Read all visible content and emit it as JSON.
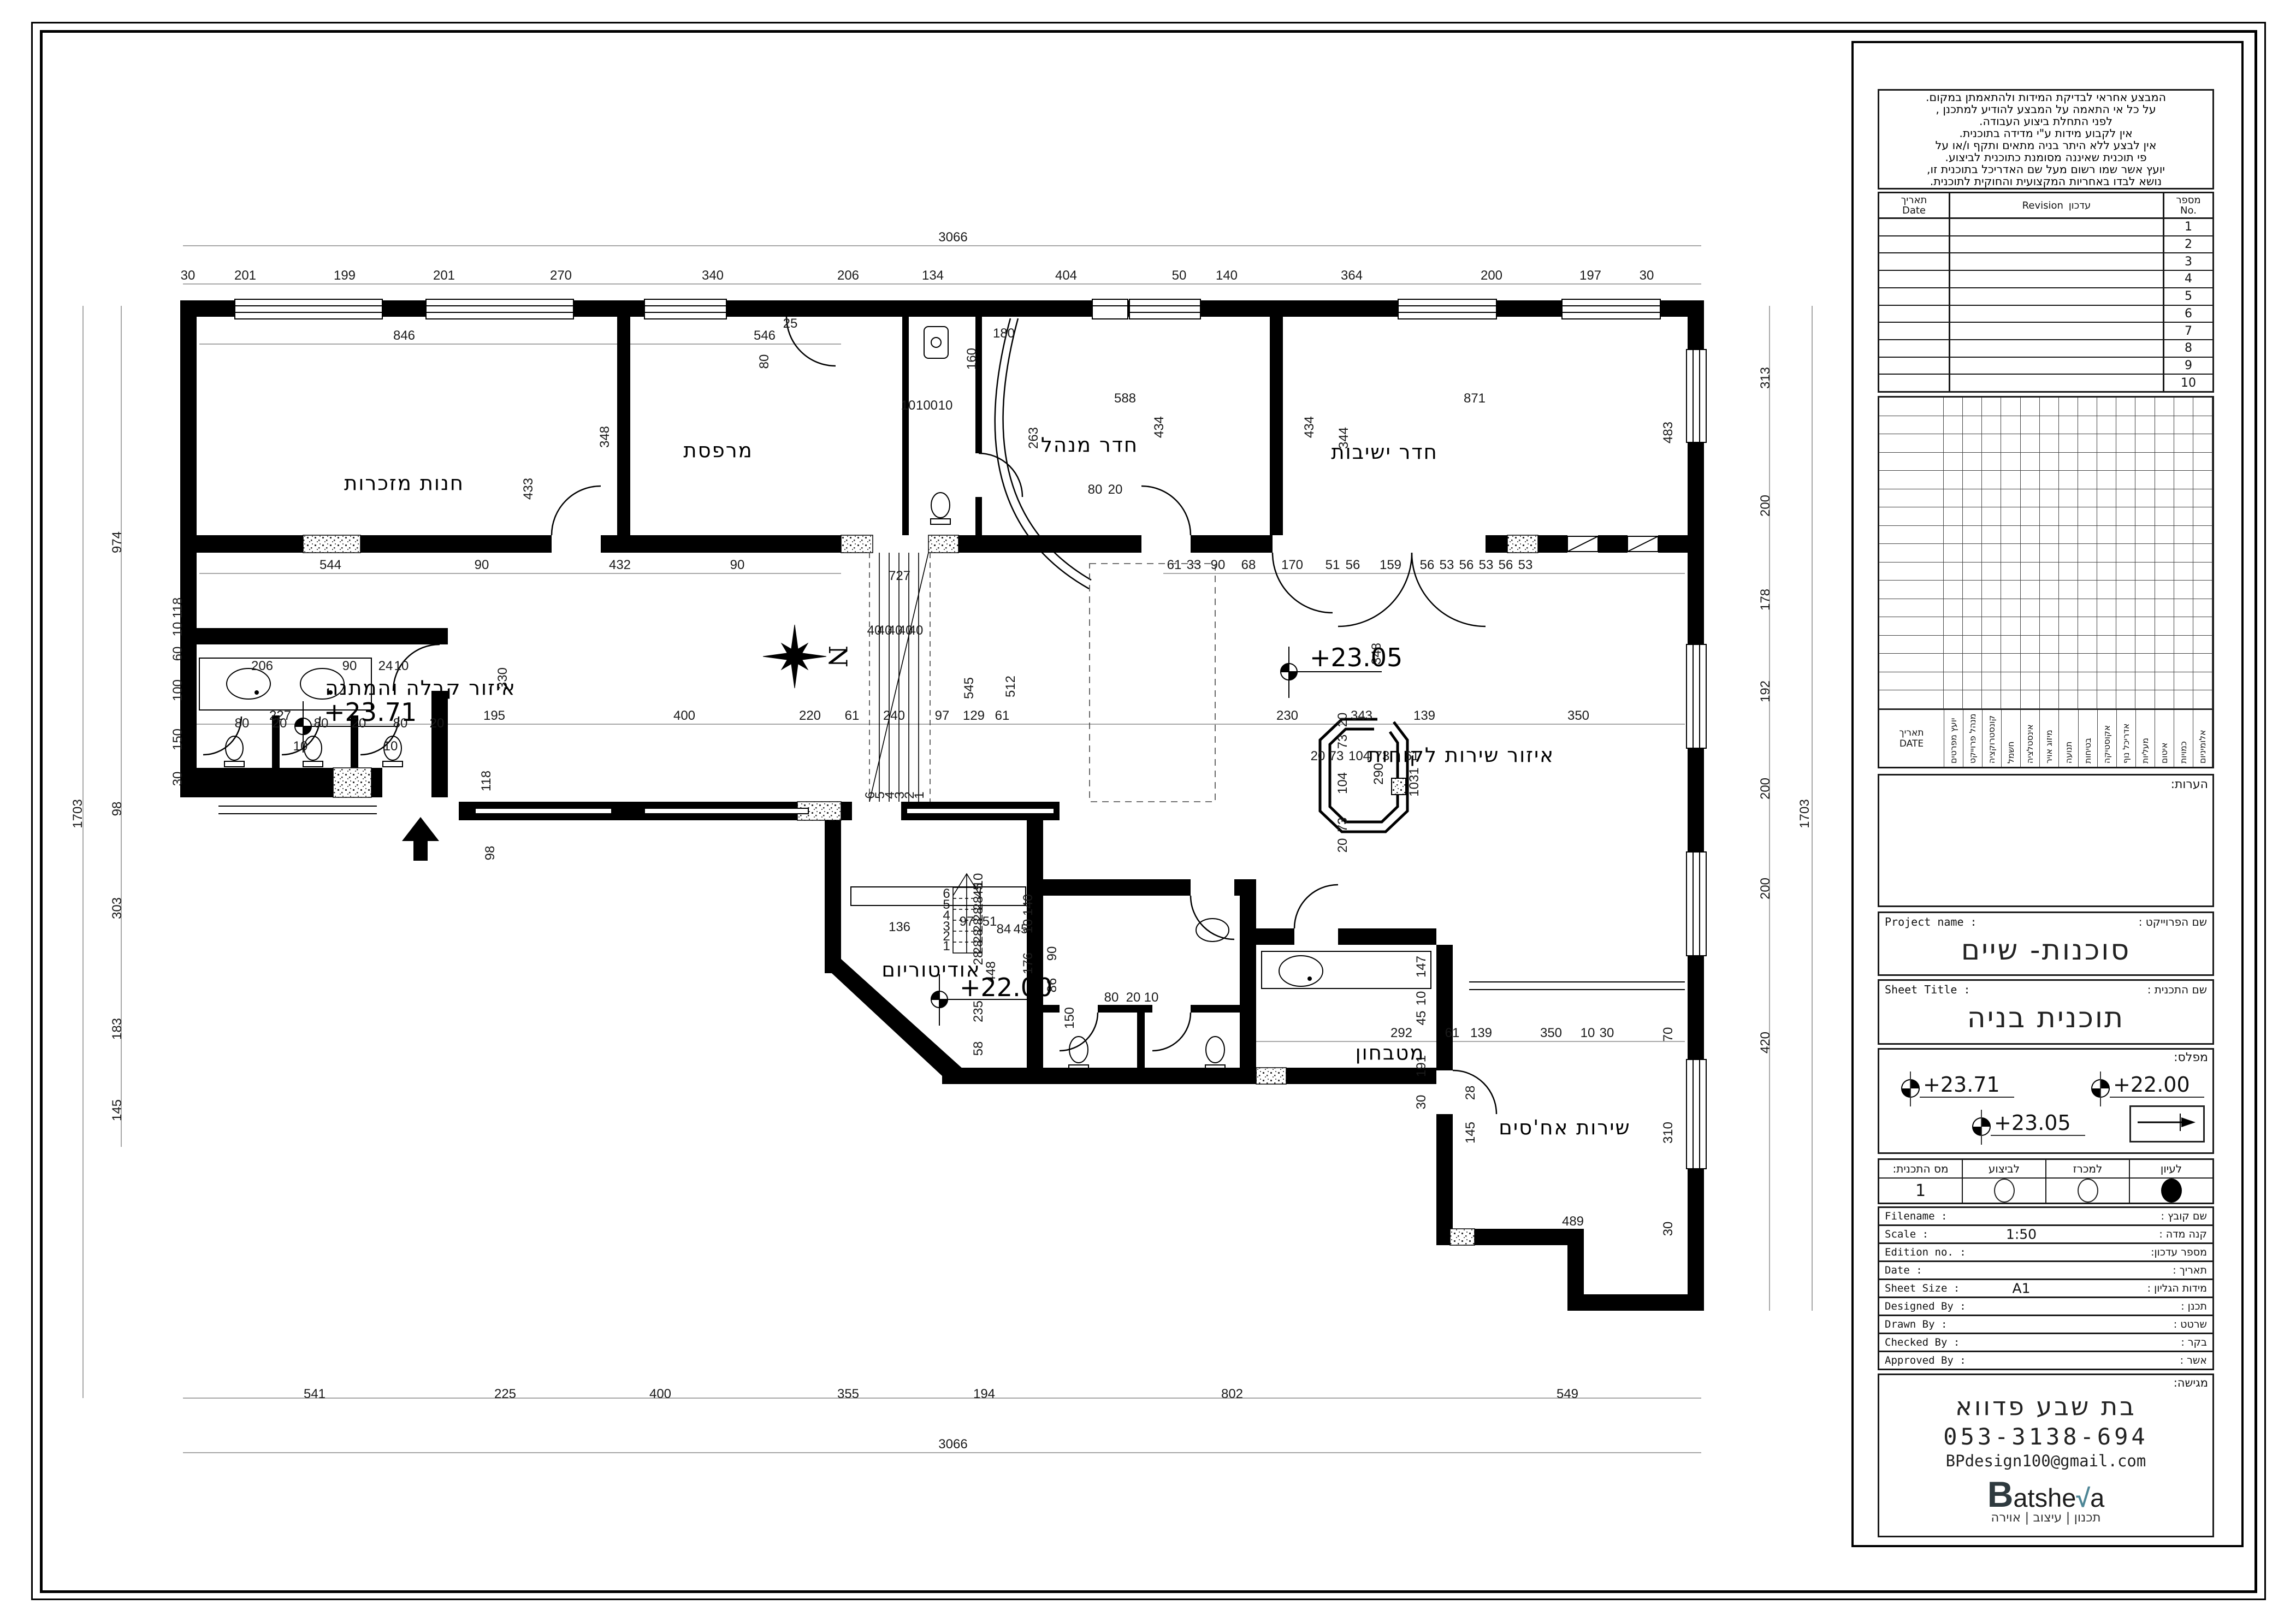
{
  "title_block": {
    "notes_lines": [
      "המבצע אחראי לבדיקת המידות ולהתאמתן במקום.",
      "על כל אי התאמה על המבצע להודיע למתכנן ,",
      "לפני התחלת ביצוע העבודה.",
      "אין לקבוע מידות ע\"י מדידה בתוכנית.",
      "אין לבצע ללא היתר בניה מתאים ותקף ו/או על",
      "פי תוכנית שאיננה מסומנת כתוכנית לביצוע.",
      "יועץ אשר שמו רשום מעל שם האדריכל בתוכנית זו,",
      "נושא לבדו באחריות המקצועית והחוקית לתוכנית."
    ],
    "revision": {
      "col_date_he": "תאריך",
      "col_date_en": "Date",
      "col_rev_he": "עדכון",
      "col_rev_en": "Revision",
      "col_no_he": "מספר",
      "col_no_en": "No.",
      "rows": [
        "1",
        "2",
        "3",
        "4",
        "5",
        "6",
        "7",
        "8",
        "9",
        "10"
      ]
    },
    "consultants": {
      "date_label_he": "תאריך",
      "date_label_en": "DATE",
      "columns": [
        "יועץ מפרטים",
        "מנהל פרוייקט",
        "קונסטרוקציה",
        "חשמל",
        "אינסטלציה",
        "מיזוג אויר",
        "תנועה",
        "בטיחות",
        "אקוסטיקה",
        "אדריכל נוף",
        "מעליות",
        "איטום",
        "כמויות",
        "אלומיניום"
      ]
    },
    "remarks_label": "הערות:",
    "project": {
      "label_en": "Project name :",
      "label_he": "שם הפרוייקט :",
      "value": "סוכנות- שיים"
    },
    "sheet": {
      "label_en": "Sheet Title :",
      "label_he": "שם התכנית :",
      "value": "תוכנית בניה"
    },
    "levels": {
      "label": "מפלס:",
      "items": [
        "+23.71",
        "+22.00",
        "+23.05"
      ]
    },
    "status": {
      "headers": [
        "מס התכנית:",
        "לביצוע",
        "למכרז",
        "לעיון"
      ],
      "plan_no": "1"
    },
    "info_rows": [
      {
        "en": "Filename :",
        "he": "שם קובץ :",
        "value": ""
      },
      {
        "en": "Scale :",
        "he": "קנה מדה :",
        "value": "1:50"
      },
      {
        "en": "Edition no. :",
        "he": "מספר עדכון:",
        "value": ""
      },
      {
        "en": "Date :",
        "he": "תאריך :",
        "value": ""
      },
      {
        "en": "Sheet Size :",
        "he": "מידות הגליון :",
        "value": "A1"
      },
      {
        "en": "Designed By :",
        "he": "תכנן :",
        "value": ""
      },
      {
        "en": "Drawn By :",
        "he": "שרטט :",
        "value": ""
      },
      {
        "en": "Checked By :",
        "he": "בקר :",
        "value": ""
      },
      {
        "en": "Approved By :",
        "he": "אשר :",
        "value": ""
      }
    ],
    "submitter": {
      "label": "מגישה:",
      "name": "בת שבע פדווא",
      "phone": "053-3138-694",
      "email": "BPdesign100@gmail.com",
      "logo": {
        "text": "Batsheva",
        "accent_color": "#4e8696"
      },
      "tagline": "תכנון | עיצוב | אוירה"
    }
  },
  "plan": {
    "north_label": "N",
    "rooms": [
      [
        740,
        897,
        "חנות מזכרות"
      ],
      [
        1315,
        837,
        "מרפסת"
      ],
      [
        1995,
        827,
        "חדר מנהל"
      ],
      [
        2535,
        840,
        "חדר ישיבות"
      ],
      [
        770,
        1272,
        "איזור קבלה והמתנה"
      ],
      [
        2675,
        1395,
        "איזור שירות לקוחות"
      ],
      [
        1705,
        1788,
        "אודיטוריום"
      ],
      [
        2545,
        1940,
        "מטבחון"
      ],
      [
        2865,
        2077,
        "שירות אח'סים"
      ]
    ],
    "levels": [
      [
        593,
        1320,
        "+23.71"
      ],
      [
        2398,
        1220,
        "+23.05"
      ],
      [
        1757,
        1824,
        "+22.00"
      ]
    ],
    "dims": [
      [
        344,
        512,
        "30"
      ],
      [
        449,
        512,
        "201"
      ],
      [
        631,
        512,
        "199"
      ],
      [
        813,
        512,
        "201"
      ],
      [
        1027,
        512,
        "270"
      ],
      [
        1305,
        512,
        "340"
      ],
      [
        1553,
        512,
        "206"
      ],
      [
        1708,
        512,
        "134"
      ],
      [
        1952,
        512,
        "404"
      ],
      [
        2159,
        512,
        "50"
      ],
      [
        2246,
        512,
        "140"
      ],
      [
        2475,
        512,
        "364"
      ],
      [
        2731,
        512,
        "200"
      ],
      [
        2912,
        512,
        "197"
      ],
      [
        3015,
        512,
        "30"
      ],
      [
        1745,
        442,
        "3066"
      ],
      [
        740,
        622,
        "846"
      ],
      [
        1400,
        622,
        "546"
      ],
      [
        1838,
        618,
        "180"
      ],
      [
        1447,
        600,
        "25"
      ],
      [
        2060,
        737,
        "588"
      ],
      [
        2700,
        737,
        "871"
      ],
      [
        1407,
        662,
        "80",
        1
      ],
      [
        975,
        895,
        "433",
        1
      ],
      [
        1115,
        800,
        "348",
        1
      ],
      [
        2130,
        782,
        "434",
        1
      ],
      [
        2405,
        782,
        "434",
        1
      ],
      [
        2468,
        802,
        "344",
        1
      ],
      [
        3062,
        792,
        "483",
        1
      ],
      [
        1787,
        657,
        "160",
        1
      ],
      [
        1900,
        802,
        "263",
        1
      ],
      [
        1663,
        750,
        "10"
      ],
      [
        1697,
        750,
        "100"
      ],
      [
        1731,
        750,
        "10"
      ],
      [
        2005,
        904,
        "80"
      ],
      [
        2042,
        904,
        "20"
      ],
      [
        605,
        1042,
        "544"
      ],
      [
        882,
        1042,
        "90"
      ],
      [
        1135,
        1042,
        "432"
      ],
      [
        1350,
        1042,
        "90"
      ],
      [
        2150,
        1042,
        "61"
      ],
      [
        2186,
        1042,
        "33"
      ],
      [
        2230,
        1042,
        "90"
      ],
      [
        2286,
        1042,
        "68"
      ],
      [
        2366,
        1042,
        "170"
      ],
      [
        2440,
        1042,
        "51"
      ],
      [
        2477,
        1042,
        "56"
      ],
      [
        2546,
        1042,
        "159"
      ],
      [
        2613,
        1042,
        "56"
      ],
      [
        2649,
        1042,
        "53"
      ],
      [
        2685,
        1042,
        "56"
      ],
      [
        2721,
        1042,
        "53"
      ],
      [
        2757,
        1042,
        "56"
      ],
      [
        2793,
        1042,
        "53"
      ],
      [
        1647,
        1062,
        "727"
      ],
      [
        1601,
        1162,
        "40"
      ],
      [
        1620,
        1162,
        "40"
      ],
      [
        1639,
        1162,
        "40"
      ],
      [
        1658,
        1162,
        "40"
      ],
      [
        1677,
        1162,
        "40"
      ],
      [
        1601,
        1456,
        "6",
        1
      ],
      [
        1619,
        1456,
        "5",
        1
      ],
      [
        1637,
        1456,
        "4",
        1
      ],
      [
        1655,
        1456,
        "3",
        1
      ],
      [
        1673,
        1456,
        "2",
        1
      ],
      [
        1691,
        1456,
        "1",
        1
      ],
      [
        513,
        1318,
        "227"
      ],
      [
        905,
        1318,
        "195"
      ],
      [
        1253,
        1318,
        "400"
      ],
      [
        1483,
        1318,
        "220"
      ],
      [
        1560,
        1318,
        "61"
      ],
      [
        1637,
        1318,
        "240"
      ],
      [
        1725,
        1318,
        "97"
      ],
      [
        1783,
        1318,
        "129"
      ],
      [
        1835,
        1318,
        "61"
      ],
      [
        2357,
        1318,
        "230"
      ],
      [
        2493,
        1318,
        "343"
      ],
      [
        2608,
        1318,
        "139"
      ],
      [
        2890,
        1318,
        "350"
      ],
      [
        928,
        1242,
        "330",
        1
      ],
      [
        1782,
        1260,
        "545",
        1
      ],
      [
        1858,
        1257,
        "512",
        1
      ],
      [
        2528,
        1197,
        "348",
        1
      ],
      [
        2597,
        1432,
        "1031",
        1
      ],
      [
        2532,
        1417,
        "290",
        1
      ],
      [
        905,
        1562,
        "98",
        1
      ],
      [
        2413,
        1392,
        "20"
      ],
      [
        2447,
        1392,
        "73"
      ],
      [
        2489,
        1392,
        "104"
      ],
      [
        2531,
        1392,
        "73"
      ],
      [
        2585,
        1392,
        "61"
      ],
      [
        2466,
        1318,
        "20",
        1
      ],
      [
        2466,
        1358,
        "73",
        1
      ],
      [
        2466,
        1434,
        "104",
        1
      ],
      [
        2466,
        1510,
        "73",
        1
      ],
      [
        2466,
        1548,
        "20",
        1
      ],
      [
        480,
        1227,
        "206"
      ],
      [
        640,
        1227,
        "90"
      ],
      [
        706,
        1227,
        "24"
      ],
      [
        735,
        1227,
        "10"
      ],
      [
        443,
        1332,
        "80"
      ],
      [
        512,
        1332,
        "20"
      ],
      [
        588,
        1332,
        "80"
      ],
      [
        657,
        1332,
        "20"
      ],
      [
        733,
        1332,
        "80"
      ],
      [
        800,
        1332,
        "20"
      ],
      [
        550,
        1374,
        "10"
      ],
      [
        715,
        1374,
        "10"
      ],
      [
        333,
        1113,
        "118",
        1
      ],
      [
        333,
        1152,
        "10",
        1
      ],
      [
        333,
        1197,
        "60",
        1
      ],
      [
        333,
        1264,
        "100",
        1
      ],
      [
        333,
        1354,
        "150",
        1
      ],
      [
        333,
        1426,
        "30",
        1
      ],
      [
        898,
        1430,
        "118",
        1
      ],
      [
        1770,
        1695,
        "97"
      ],
      [
        1647,
        1705,
        "136"
      ],
      [
        1812,
        1695,
        "51"
      ],
      [
        1838,
        1709,
        "84"
      ],
      [
        1869,
        1709,
        "45"
      ],
      [
        1799,
        1654,
        "28",
        1
      ],
      [
        1799,
        1674,
        "28",
        1
      ],
      [
        1799,
        1694,
        "28",
        1
      ],
      [
        1799,
        1714,
        "28",
        1
      ],
      [
        1799,
        1734,
        "28",
        1
      ],
      [
        1799,
        1754,
        "28",
        1
      ],
      [
        1799,
        1630,
        "45",
        1
      ],
      [
        1799,
        1612,
        "10",
        1
      ],
      [
        1822,
        1780,
        "448",
        1
      ],
      [
        1799,
        1852,
        "235",
        1
      ],
      [
        1799,
        1920,
        "58",
        1
      ],
      [
        1890,
        1657,
        "140",
        1
      ],
      [
        1890,
        1696,
        "10",
        1
      ],
      [
        1890,
        1764,
        "176",
        1
      ],
      [
        1934,
        1746,
        "90",
        1
      ],
      [
        1934,
        1804,
        "86",
        1
      ],
      [
        1966,
        1864,
        "150",
        1
      ],
      [
        2035,
        1834,
        "80"
      ],
      [
        2075,
        1834,
        "20"
      ],
      [
        2108,
        1834,
        "10"
      ],
      [
        2566,
        1899,
        "292"
      ],
      [
        2659,
        1899,
        "61"
      ],
      [
        2712,
        1899,
        "139"
      ],
      [
        2840,
        1899,
        "350"
      ],
      [
        2907,
        1899,
        "10"
      ],
      [
        2942,
        1899,
        "30"
      ],
      [
        2610,
        1770,
        "147",
        1
      ],
      [
        2610,
        1828,
        "10",
        1
      ],
      [
        2610,
        1864,
        "45",
        1
      ],
      [
        2610,
        1952,
        "191",
        1
      ],
      [
        2610,
        2018,
        "30",
        1
      ],
      [
        2700,
        2001,
        "28",
        1
      ],
      [
        2700,
        2074,
        "145",
        1
      ],
      [
        2880,
        2244,
        "489"
      ],
      [
        3062,
        2074,
        "310",
        1
      ],
      [
        3062,
        1894,
        "70",
        1
      ],
      [
        3062,
        2250,
        "30",
        1
      ],
      [
        576,
        2560,
        "541"
      ],
      [
        925,
        2560,
        "225"
      ],
      [
        1209,
        2560,
        "400"
      ],
      [
        1553,
        2560,
        "355"
      ],
      [
        1802,
        2560,
        "194"
      ],
      [
        2256,
        2560,
        "802"
      ],
      [
        2870,
        2560,
        "549"
      ],
      [
        1745,
        2652,
        "3066"
      ],
      [
        222,
        993,
        "974",
        1
      ],
      [
        222,
        1481,
        "98",
        1
      ],
      [
        222,
        1663,
        "303",
        1
      ],
      [
        222,
        1884,
        "183",
        1
      ],
      [
        222,
        2033,
        "145",
        1
      ],
      [
        150,
        1490,
        "1703",
        1
      ],
      [
        3240,
        692,
        "313",
        1
      ],
      [
        3240,
        926,
        "200",
        1
      ],
      [
        3240,
        1098,
        "178",
        1
      ],
      [
        3240,
        1266,
        "192",
        1
      ],
      [
        3240,
        1444,
        "200",
        1
      ],
      [
        3240,
        1627,
        "200",
        1
      ],
      [
        3240,
        1909,
        "420",
        1
      ],
      [
        3312,
        1490,
        "1703",
        1
      ],
      [
        1733,
        1644,
        "6"
      ],
      [
        1733,
        1664,
        "5"
      ],
      [
        1733,
        1684,
        "4"
      ],
      [
        1733,
        1704,
        "3"
      ],
      [
        1733,
        1722,
        "2"
      ],
      [
        1733,
        1740,
        "1"
      ]
    ]
  }
}
